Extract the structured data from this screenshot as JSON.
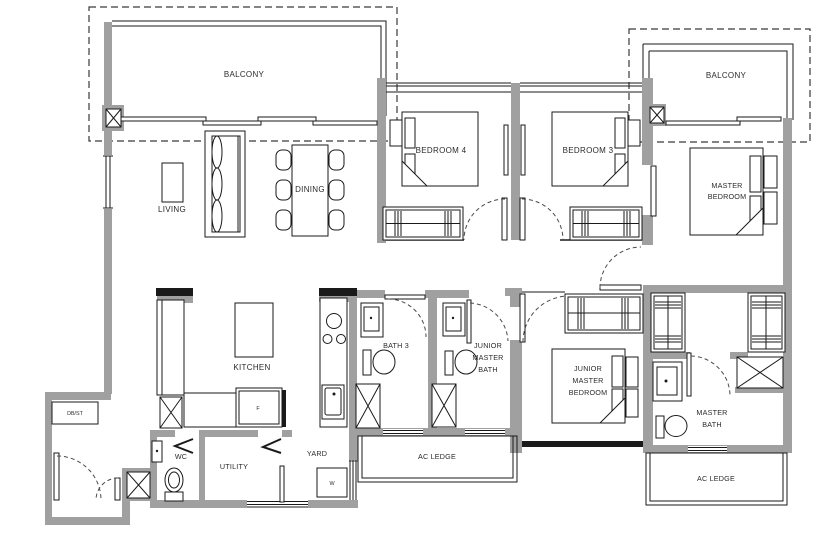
{
  "floorplan": {
    "labels": {
      "balcony_left": "BALCONY",
      "balcony_right": "BALCONY",
      "living": "LIVING",
      "dining": "DINING",
      "bedroom4": "BEDROOM 4",
      "bedroom3": "BEDROOM 3",
      "master_bedroom": [
        "MASTER",
        "BEDROOM"
      ],
      "kitchen": "KITCHEN",
      "bath3": "BATH 3",
      "junior_master_bath": [
        "JUNIOR",
        "MASTER",
        "BATH"
      ],
      "junior_master_bedroom": [
        "JUNIOR",
        "MASTER",
        "BEDROOM"
      ],
      "master_bath": [
        "MASTER",
        "BATH"
      ],
      "wc": "WC",
      "utility": "UTILITY",
      "yard": "YARD",
      "db_st": "DB/ST",
      "ac_ledge_left": "AC LEDGE",
      "ac_ledge_right": "AC LEDGE",
      "fridge": "F",
      "washer": "W"
    },
    "colors": {
      "wall": "#a0a0a0",
      "line": "#1a1a1a",
      "background": "#ffffff"
    }
  }
}
